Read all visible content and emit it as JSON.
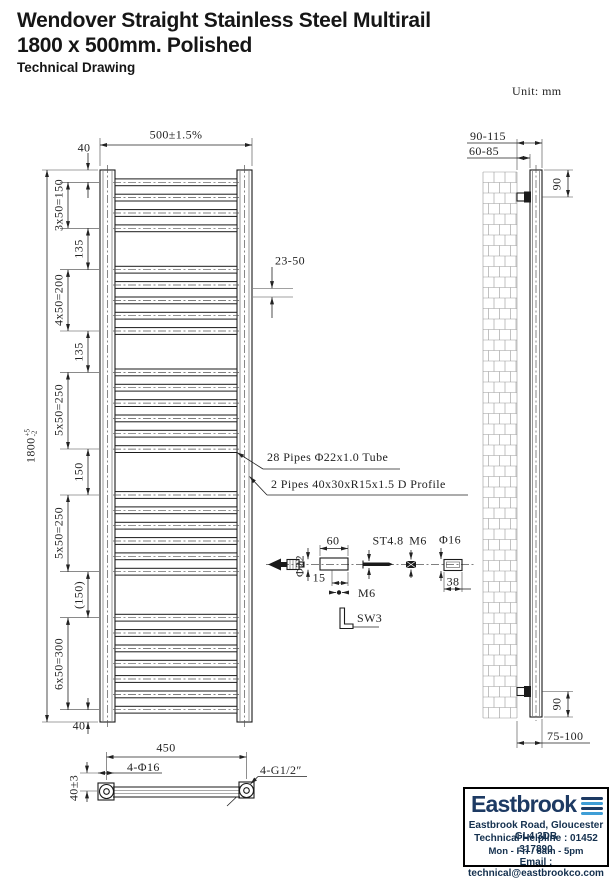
{
  "header": {
    "title_line1": "Wendover Straight Stainless Steel Multirail",
    "title_line2": "1800 x 500mm. Polished",
    "subtitle": "Technical Drawing",
    "unit_label": "Unit: mm"
  },
  "front_view": {
    "width_dim": "500±1.5%",
    "height_dim": "1800",
    "height_tol_plus": "+5",
    "height_tol_minus": "-2",
    "top_offset_dim": "40",
    "bottom_offset_dim": "40",
    "chain_dims": [
      "3x50=150",
      "135",
      "4x50=200",
      "135",
      "5x50=250",
      "150",
      "5x50=250",
      "(150)",
      "6x50=300"
    ],
    "gap_dim": "23-50",
    "pipe_note": "28 Pipes Φ22x1.0 Tube",
    "profile_note": "2 Pipes 40x30xR15x1.5 D Profile"
  },
  "side_view": {
    "wall_to_back_dim": "90-115",
    "wall_to_front_dim": "60-85",
    "top_bracket_dim": "90",
    "bottom_bracket_dim": "90",
    "bottom_clearance_dim": "75-100"
  },
  "detail_view": {
    "plug_dia": "Φ22",
    "sleeve_length": "60",
    "sleeve_inset": "15",
    "screw_spec": "ST4.8",
    "nut_spec": "M6",
    "cap_dia": "Φ16",
    "cap_length": "38",
    "grub_screw": "M6",
    "allen_key": "SW3"
  },
  "bottom_view": {
    "hole_centres_dim": "450",
    "holes_spec": "4-Φ16",
    "thread_spec": "4-G1/2″",
    "offset_dim": "40±3"
  },
  "footer": {
    "brand": "Eastbrook",
    "address": "Eastbrook Road, Gloucester GL4 3DB",
    "helpline": "Technical Helpline : 01452 317890",
    "hours": "Mon - Fri / 8am - 5pm",
    "email": "Email : technical@eastbrookco.com",
    "brand_color": "#1d3a63",
    "logo_blue": "#3f9ed6"
  }
}
